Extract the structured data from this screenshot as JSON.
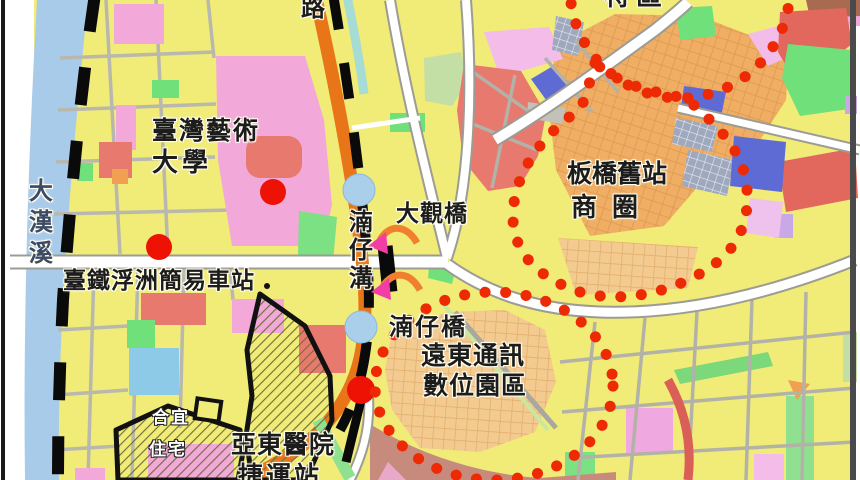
{
  "map": {
    "labels": {
      "river_vertical": "大漢溪",
      "road_partial_top": "路",
      "district_partial_top": "特區",
      "university_line1": "臺灣藝術",
      "university_line2": "大學",
      "tra_station": "臺鐵浮洲簡易車站",
      "daguan_bridge": "大觀橋",
      "nanzai_ditch_vertical": "湳仔溝",
      "nanzai_bridge": "湳仔橋",
      "banqiao_old_station_line1": "板橋舊站",
      "banqiao_old_station_line2": "商 圈",
      "fareastone_park_line1": "遠東通訊",
      "fareastone_park_line2": "數位園區",
      "housing_line1": "合宜",
      "housing_line2": "住宅",
      "hospital_station_line1": "亞東醫院",
      "hospital_station_line2": "捷運站"
    },
    "colors": {
      "land_base": "#F1EB77",
      "river_blue": "#A9CBEA",
      "residential_pink": "#F2A8D8",
      "commercial_salmon": "#E8796E",
      "park_green": "#6FE07A",
      "institution_blue": "#5F6BD5",
      "arterial_orange": "#E87517",
      "district_grid_tan": "#EFAE64",
      "boundary_dot_red": "#EE2A05",
      "poi_marker_red": "#EE1205",
      "station_circle_blue": "#A9CFEA",
      "arrow_magenta": "#F23CA6",
      "railway_black": "#0a0a0a"
    }
  }
}
